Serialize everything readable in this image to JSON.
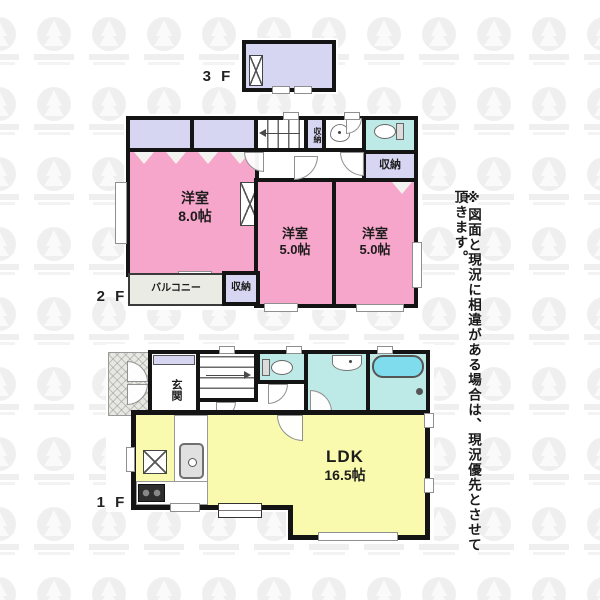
{
  "note": {
    "text": "※図面と現況に相違がある場合は、現況優先とさせて頂きます。"
  },
  "floor3": {
    "label": "3 F"
  },
  "floor2": {
    "label": "2 F",
    "room8": {
      "name": "洋室",
      "size": "8.0帖"
    },
    "room5a": {
      "name": "洋室",
      "size": "5.0帖"
    },
    "room5b": {
      "name": "洋室",
      "size": "5.0帖"
    },
    "balcony": {
      "label": "バルコニー"
    },
    "storage_hall": {
      "label": "収納"
    },
    "storage_toilet": {
      "label": "収納"
    },
    "storage_balcony": {
      "label": "収納"
    }
  },
  "floor1": {
    "label": "1 F",
    "genkan": {
      "label": "玄関"
    },
    "ldk": {
      "name": "LDK",
      "size": "16.5帖"
    }
  },
  "colors": {
    "room_pink": "#f7a6cb",
    "room_yellow": "#fafaae",
    "room_lavender": "#d6d6f2",
    "room_cyan": "#bdeae6",
    "bathtub_cyan": "#7fdcec",
    "balcony_gray": "#ebebe6",
    "wall": "#141414"
  }
}
